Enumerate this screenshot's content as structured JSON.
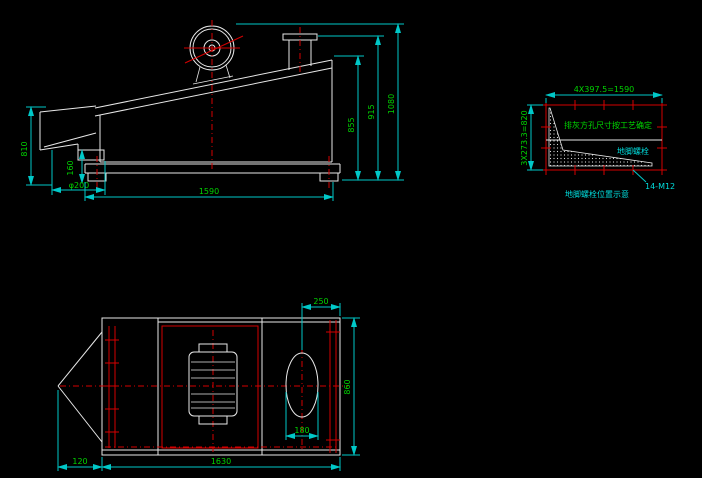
{
  "drawing": {
    "background": "#000000",
    "colors": {
      "line": "#e8e8e8",
      "centerline": "#d40000",
      "dimension_line": "#00c8c8",
      "dimension_text": "#00d400",
      "annotation_text": "#00dcdc"
    },
    "side_view": {
      "dim_left_height": "810",
      "dim_outlet_height": "160",
      "dim_outlet_dia": "φ200",
      "dim_base_length": "1590",
      "dim_body_height": "855",
      "dim_chimney_height": "915",
      "dim_total_height": "1080"
    },
    "bolt_detail": {
      "dim_top": "4X397.5=1590",
      "dim_left": "3X273.3=820",
      "note_inside": "排灰方孔尺寸按工艺确定",
      "label_zone": "地脚螺栓",
      "bolt_spec": "14-M12",
      "caption": "地脚螺栓位置示意"
    },
    "plan_view": {
      "dim_outlet_offset": "250",
      "dim_outlet_width": "180",
      "dim_body_width": "860",
      "dim_body_length": "1630",
      "dim_hopper_length": "120"
    }
  }
}
